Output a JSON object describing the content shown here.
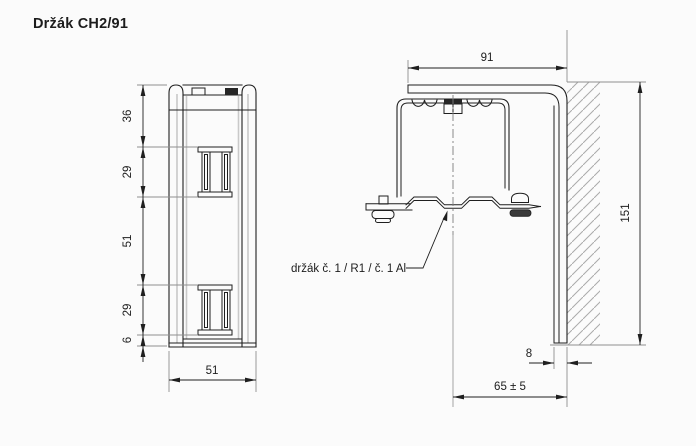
{
  "title": "Držák CH2/91",
  "front_view": {
    "height_dims": {
      "seg1": "36",
      "seg2": "29",
      "seg3": "51",
      "seg4": "29",
      "seg5": "6"
    },
    "width_dim": "51"
  },
  "side_view": {
    "width_dim": "91",
    "height_dim": "151",
    "leg_thickness_dim": "8",
    "offset_dim": "65 ± 5",
    "leader_label": "držák č. 1 / R1 / č. 1 Al"
  },
  "colors": {
    "background": "#fbfbfb",
    "line": "#1f1f1f",
    "auxiliary": "#8f8f8f",
    "hatch": "#ababab"
  }
}
